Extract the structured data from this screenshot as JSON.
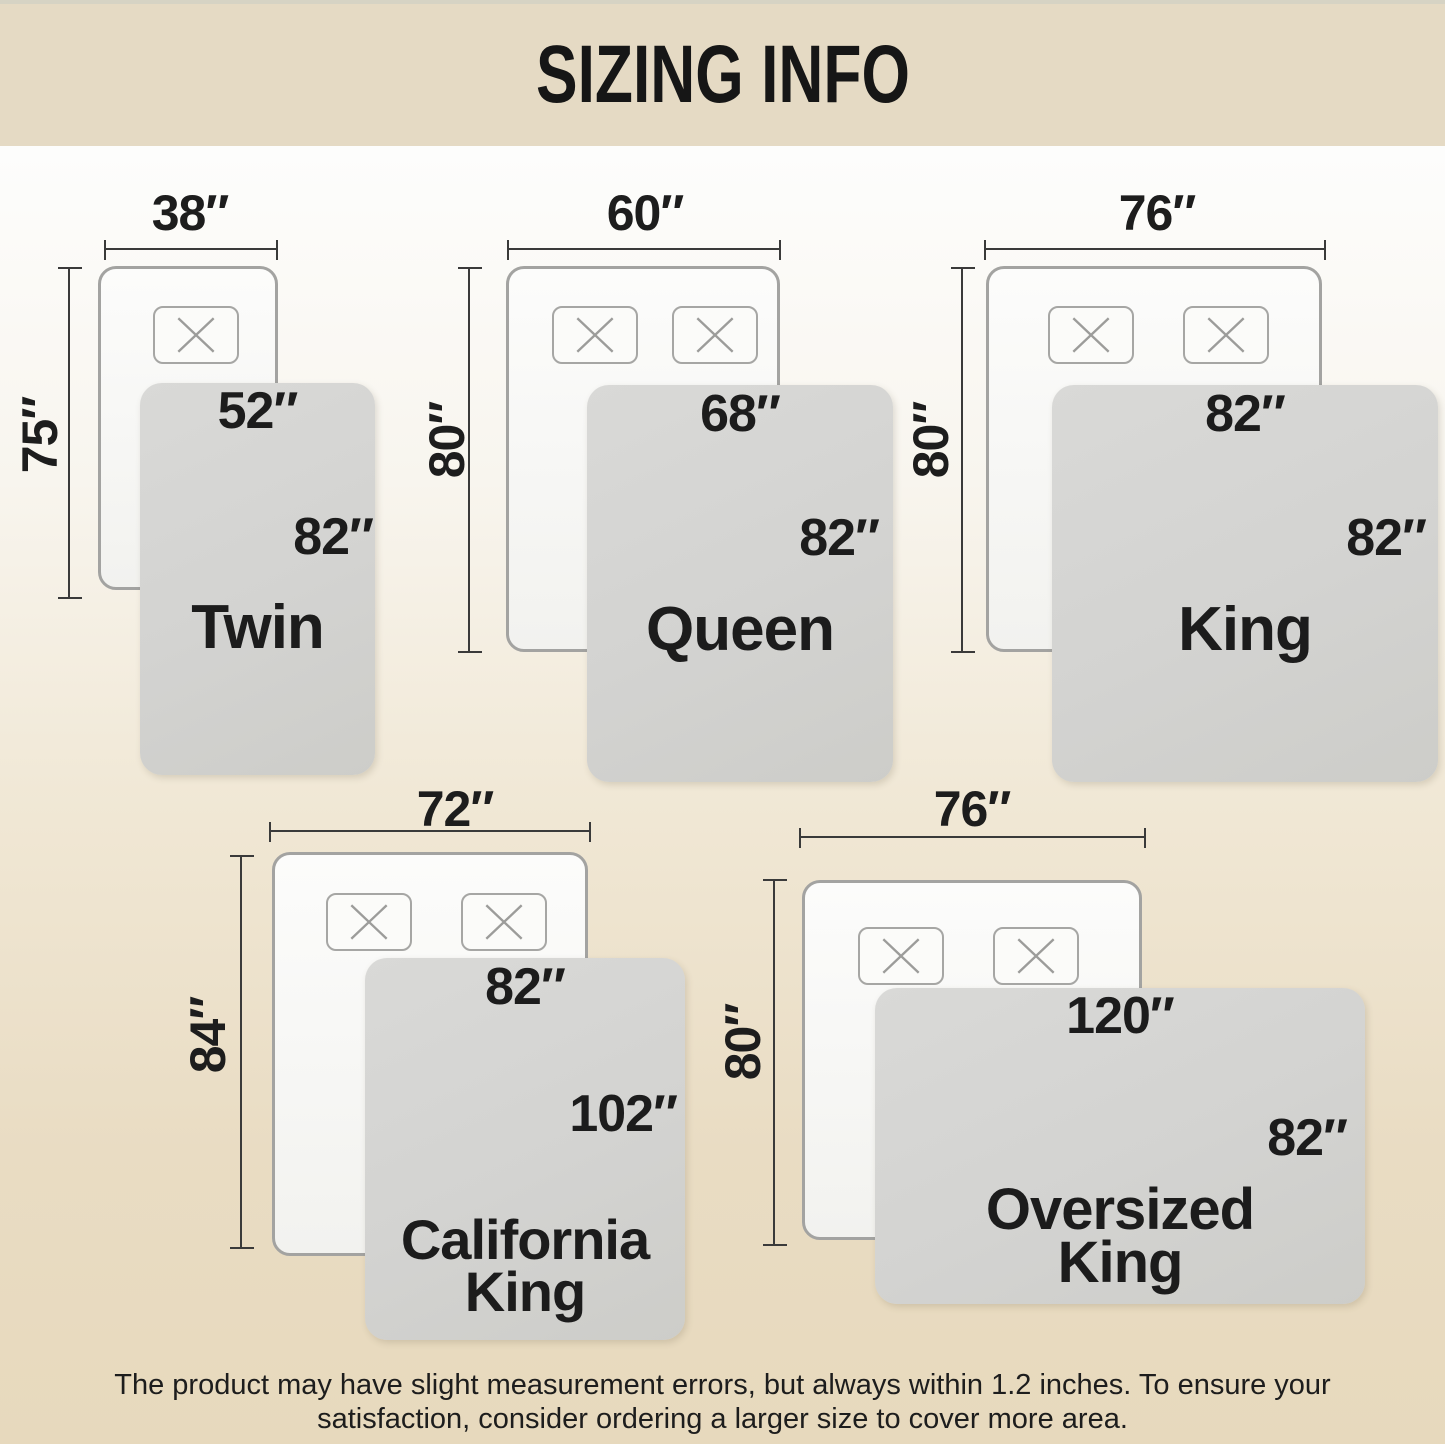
{
  "title": "SIZING INFO",
  "footnote": {
    "line1": "The product may have slight measurement errors, but always within 1.2 inches. To ensure your",
    "line2": "satisfaction, consider ordering a larger size to cover more area."
  },
  "sizes": [
    {
      "name_line1": "Twin",
      "name_line2": "",
      "bed_width": "38″",
      "bed_length": "75″",
      "blanket_width": "52″",
      "blanket_length": "82″"
    },
    {
      "name_line1": "Queen",
      "name_line2": "",
      "bed_width": "60″",
      "bed_length": "80″",
      "blanket_width": "68″",
      "blanket_length": "82″"
    },
    {
      "name_line1": "King",
      "name_line2": "",
      "bed_width": "76″",
      "bed_length": "80″",
      "blanket_width": "82″",
      "blanket_length": "82″"
    },
    {
      "name_line1": "California",
      "name_line2": "King",
      "bed_width": "72″",
      "bed_length": "84″",
      "blanket_width": "82″",
      "blanket_length": "102″"
    },
    {
      "name_line1": "Oversized",
      "name_line2": "King",
      "bed_width": "76″",
      "bed_length": "80″",
      "blanket_width": "120″",
      "blanket_length": "82″"
    }
  ],
  "icons": {
    "pillow_marker": "pillow-x-icon"
  },
  "colors": {
    "banner": "#e5dac4",
    "banner_top_strip": "#d6d3c4",
    "background_top": "#fdfdfc",
    "background_bottom": "#e7d9bd",
    "bed_fill": "#fbfbf9",
    "bed_border": "#a3a3a1",
    "blanket_fill": "#d4d4d2",
    "dimension_line": "#3a3a3a",
    "text": "#1c1c1c"
  }
}
